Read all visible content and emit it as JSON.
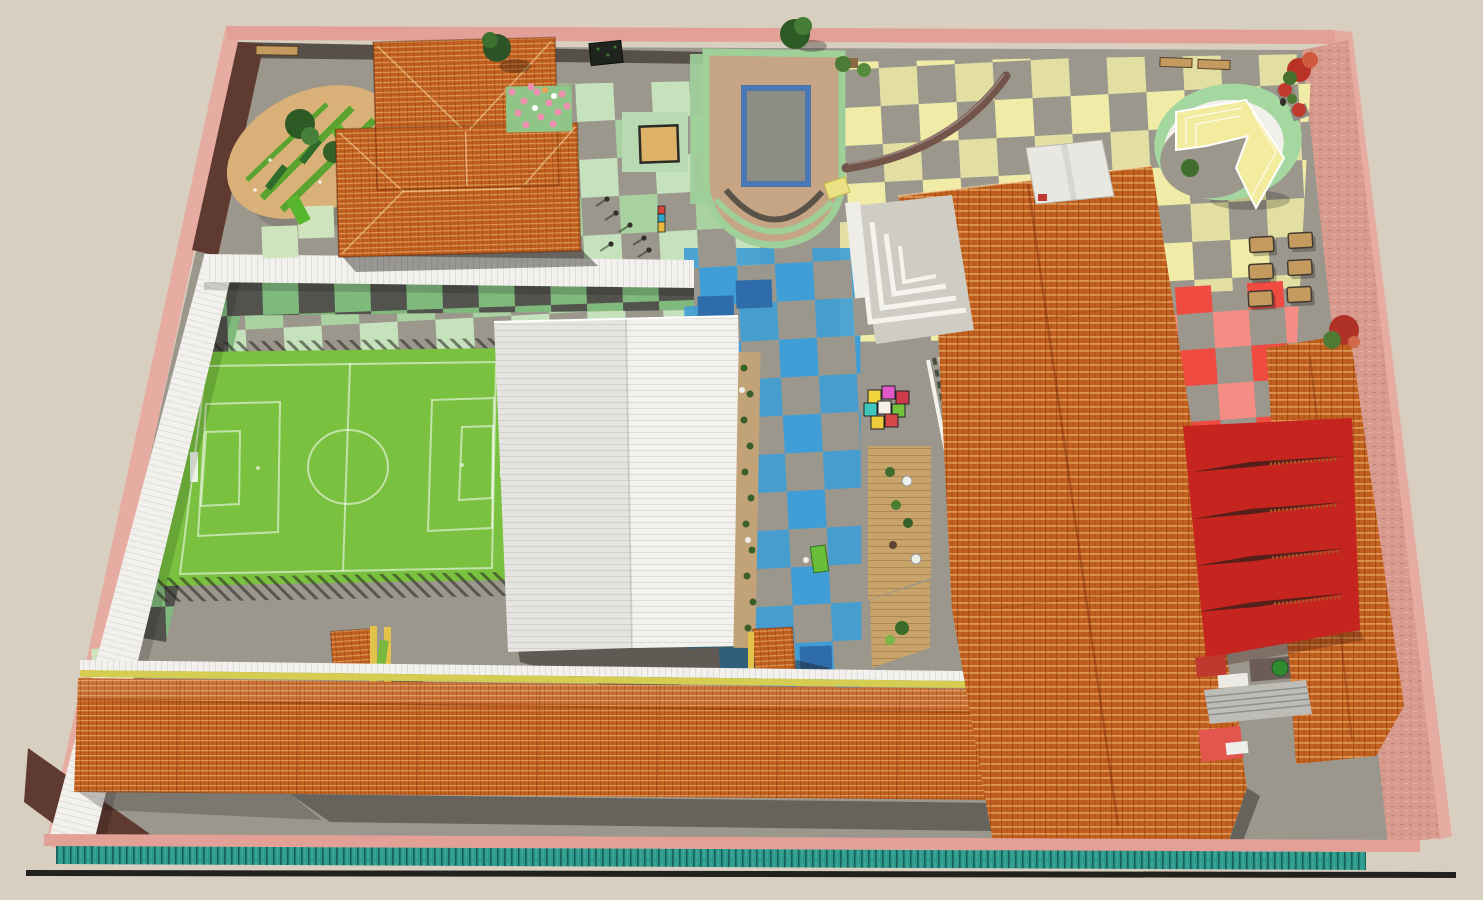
{
  "scene": {
    "type": "aerial-3d-architectural-render",
    "description": "Bird's-eye 3D rendering of a school campus site plan: orange-tiled roof buildings, soccer field, U-shaped pool terrace, oval sand garden, amphitheater, checkered plazas (green, yellow, blue, red), red shade canopy, wooden deck, perimeter pink wall with teal hedge",
    "visible_text": []
  },
  "colors": {
    "bg": "#d8cfc0",
    "pavement": "#9b978d",
    "wall-pink": "#e2a096",
    "wall-pink-outer": "#e7aca1",
    "wall-maroon": "#5e3a30",
    "wall-darkband": "#565049",
    "brick": "#d89a8d",
    "roof-orange": "#c2601f",
    "white-roof": "#f2f1ed",
    "field-green": "#79c13f",
    "field-line": "#ffffff",
    "tile-green": "#a9d2a0",
    "tile-green2": "#c6e2bc",
    "tile-green3": "#7fb97c",
    "tile-green-pale": "#cfe3bc",
    "tile-dark": "#53534e",
    "tile-yellow": "#f0eba6",
    "tile-blue": "#3f9ed6",
    "tile-blue-dark": "#2e6cab",
    "tile-red": "#ef4b41",
    "tile-red2": "#f58d84",
    "pool-deck": "#c5a584",
    "pool-border": "#4a79b0",
    "pool-water": "#8d8d85",
    "pool-rim": "#9fd09a",
    "bench-brown": "#73544a",
    "amph-green": "#a5d8a0",
    "amph-white": "#f1f0ea",
    "amph-yellow": "#f3eb9e",
    "deck-wood": "#c8a36a",
    "hedge": "#2a9a8c",
    "sail-red": "#c5251e",
    "sail-dark": "#571f1a",
    "shadow": "rgba(28,26,23,0.42)",
    "sand-tan": "#d9b078",
    "grass-green": "#5aa32e",
    "lounger-green": "#69bf3a",
    "yellow-line": "#d5cc52",
    "post-yellow": "#e3c24a",
    "balloon-green": "#8fc687",
    "balloon-pink": "#ef8fb0",
    "wood-bench": "#c49a5e",
    "white-detail": "#f2f1ec",
    "people-dark": "#33302c"
  },
  "features": {
    "buildings": [
      {
        "id": "building-top-left",
        "roof": "orange-tile",
        "shape": "L"
      },
      {
        "id": "main-building",
        "roof": "orange-tile",
        "location": "right-center"
      },
      {
        "id": "white-gym-building",
        "roof": "white-corrugated",
        "location": "center"
      },
      {
        "id": "south-building",
        "roof": "orange-tile",
        "location": "bottom",
        "shape": "long-bar"
      },
      {
        "id": "east-building",
        "roof": "orange-tile",
        "location": "right"
      },
      {
        "id": "kiosk-towers",
        "count": 2
      }
    ],
    "soccer_field": {
      "markings": "white",
      "surface": "green turf"
    },
    "pool": {
      "shape": "U-shaped terrace with rectangular pool"
    },
    "red_shade_canopy": {
      "slits": 4
    },
    "plazas": [
      "green-checker-court",
      "yellow-checker-plaza",
      "blue-checker-path",
      "red-checker-patch"
    ],
    "oval_garden": {
      "trees": 2,
      "benches": 2
    },
    "amphitheater": {
      "location": "top-right"
    },
    "movable_benches": {
      "count": 6
    },
    "wood_deck": {
      "tables": 2
    },
    "toy_blocks": {
      "count": 8
    },
    "balloon_plot": {
      "balloons": 12
    },
    "perimeter": {
      "wall": "pink",
      "hedge": "teal"
    },
    "people": {
      "count": 7
    }
  }
}
